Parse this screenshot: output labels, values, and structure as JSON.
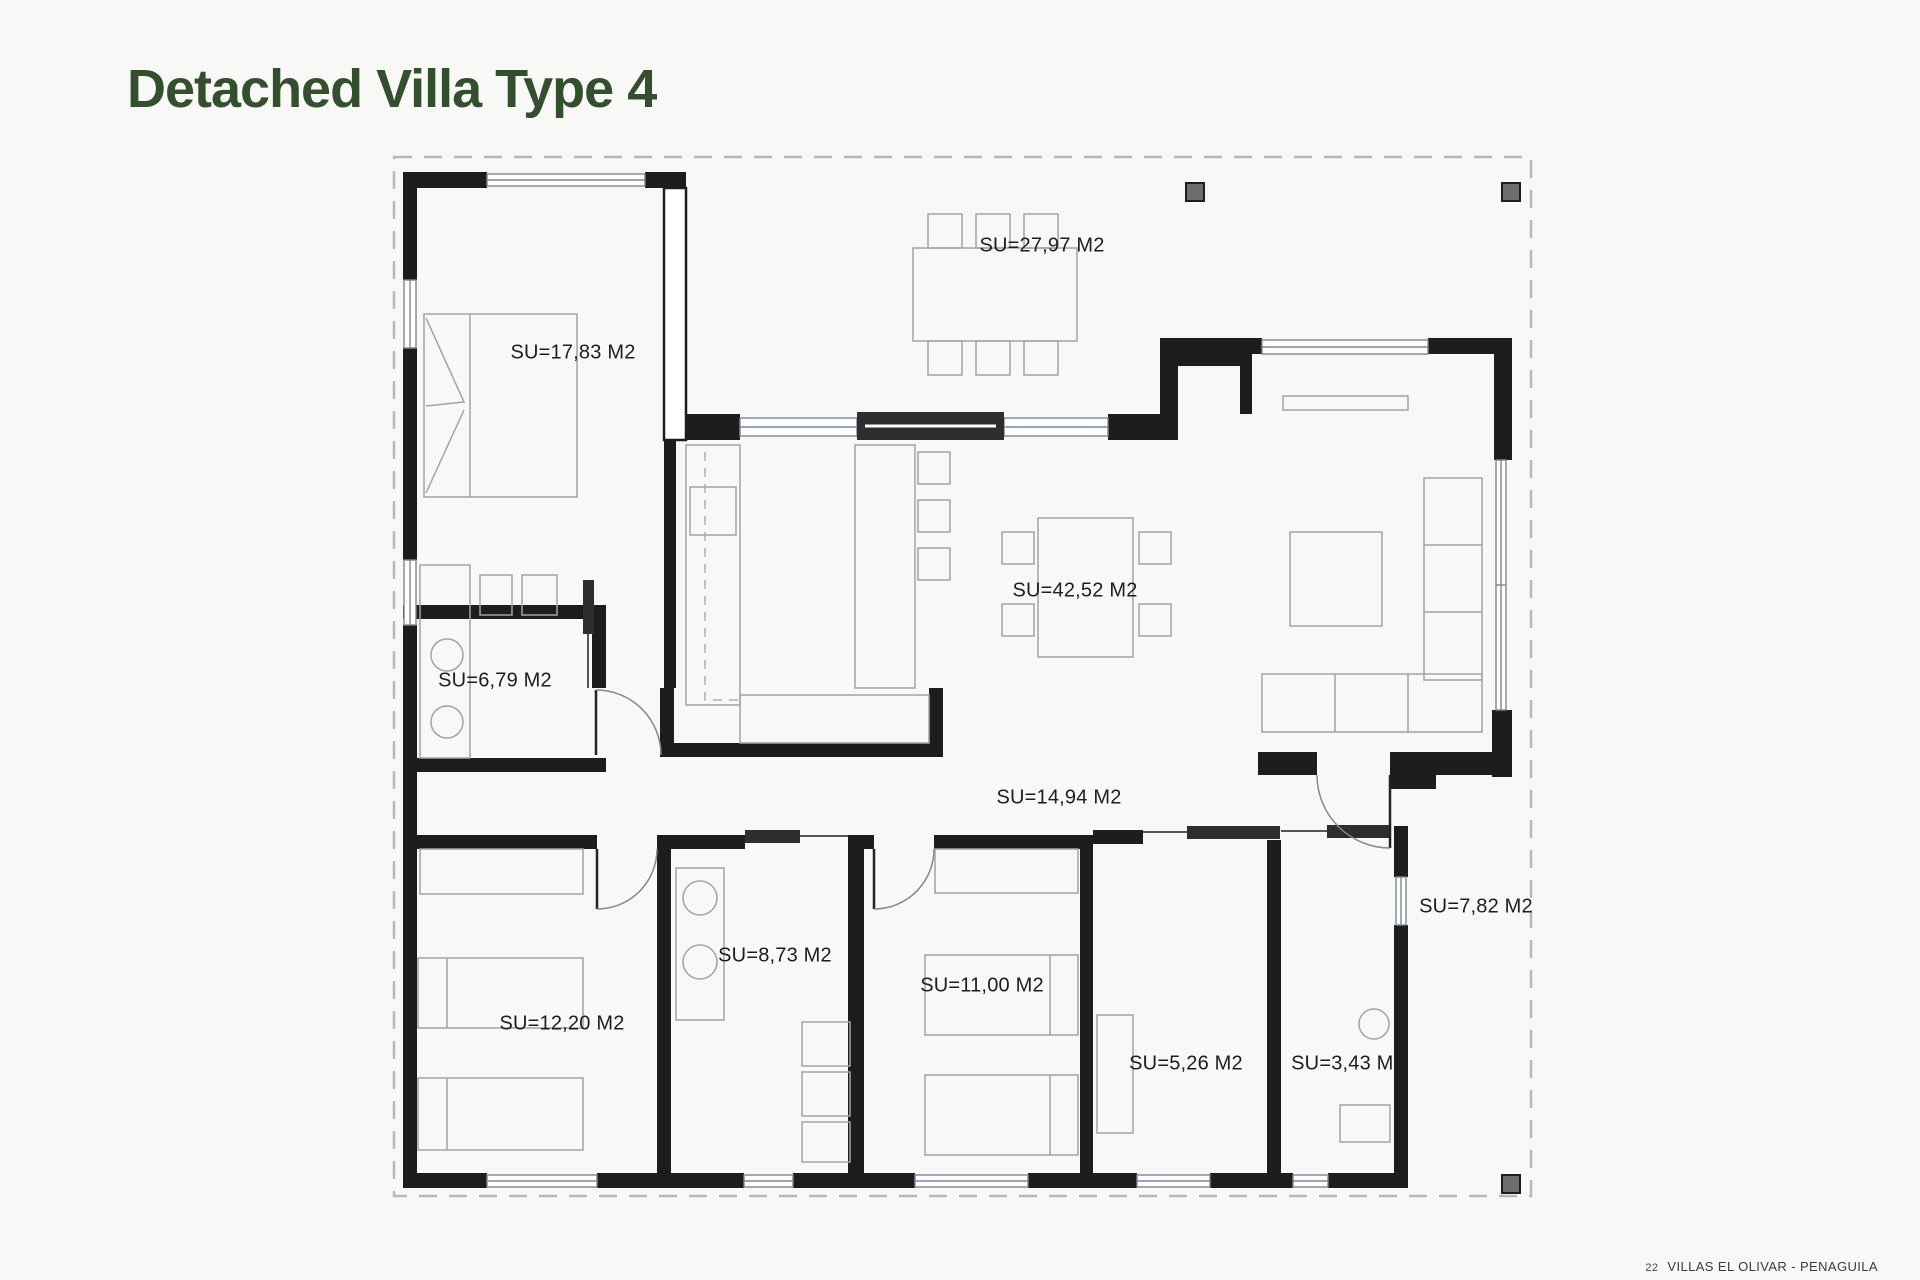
{
  "page": {
    "title": "Detached Villa Type 4",
    "footer": {
      "page_number": "22",
      "project": "VILLAS EL OLIVAR - PENAGUILA"
    }
  },
  "colors": {
    "background": "#f8f8f6",
    "title_green": "#344f2e",
    "wall_black": "#1d1d1d",
    "furniture_gray": "#a3a3a3",
    "window_gray_blue": "#7c8696",
    "boundary_dash_gray": "#b8b8b8",
    "column_gray": "#6e6e6e",
    "label_text": "#1d1d1d"
  },
  "floor_plan": {
    "drawing_type": "architectural floor plan",
    "area_unit": "M2",
    "rooms": [
      {
        "id": "master-bedroom",
        "label": "SU=17,83 M2",
        "area_m2": "17,83"
      },
      {
        "id": "terrace",
        "label": "SU=27,97 M2",
        "area_m2": "27,97"
      },
      {
        "id": "living-dining",
        "label": "SU=42,52 M2",
        "area_m2": "42,52"
      },
      {
        "id": "laundry",
        "label": "SU=6,79 M2",
        "area_m2": "6,79"
      },
      {
        "id": "hallway",
        "label": "SU=14,94 M2",
        "area_m2": "14,94"
      },
      {
        "id": "bathroom-1",
        "label": "SU=8,73 M2",
        "area_m2": "8,73"
      },
      {
        "id": "bedroom-2",
        "label": "SU=11,00 M2",
        "area_m2": "11,00"
      },
      {
        "id": "bedroom-3",
        "label": "SU=12,20 M2",
        "area_m2": "12,20"
      },
      {
        "id": "dressing-room",
        "label": "SU=5,26 M2",
        "area_m2": "5,26"
      },
      {
        "id": "bathroom-2",
        "label": "SU=3,43 M2",
        "area_m2": "3,43"
      },
      {
        "id": "porch",
        "label": "SU=7,82 M2",
        "area_m2": "7,82"
      }
    ]
  }
}
